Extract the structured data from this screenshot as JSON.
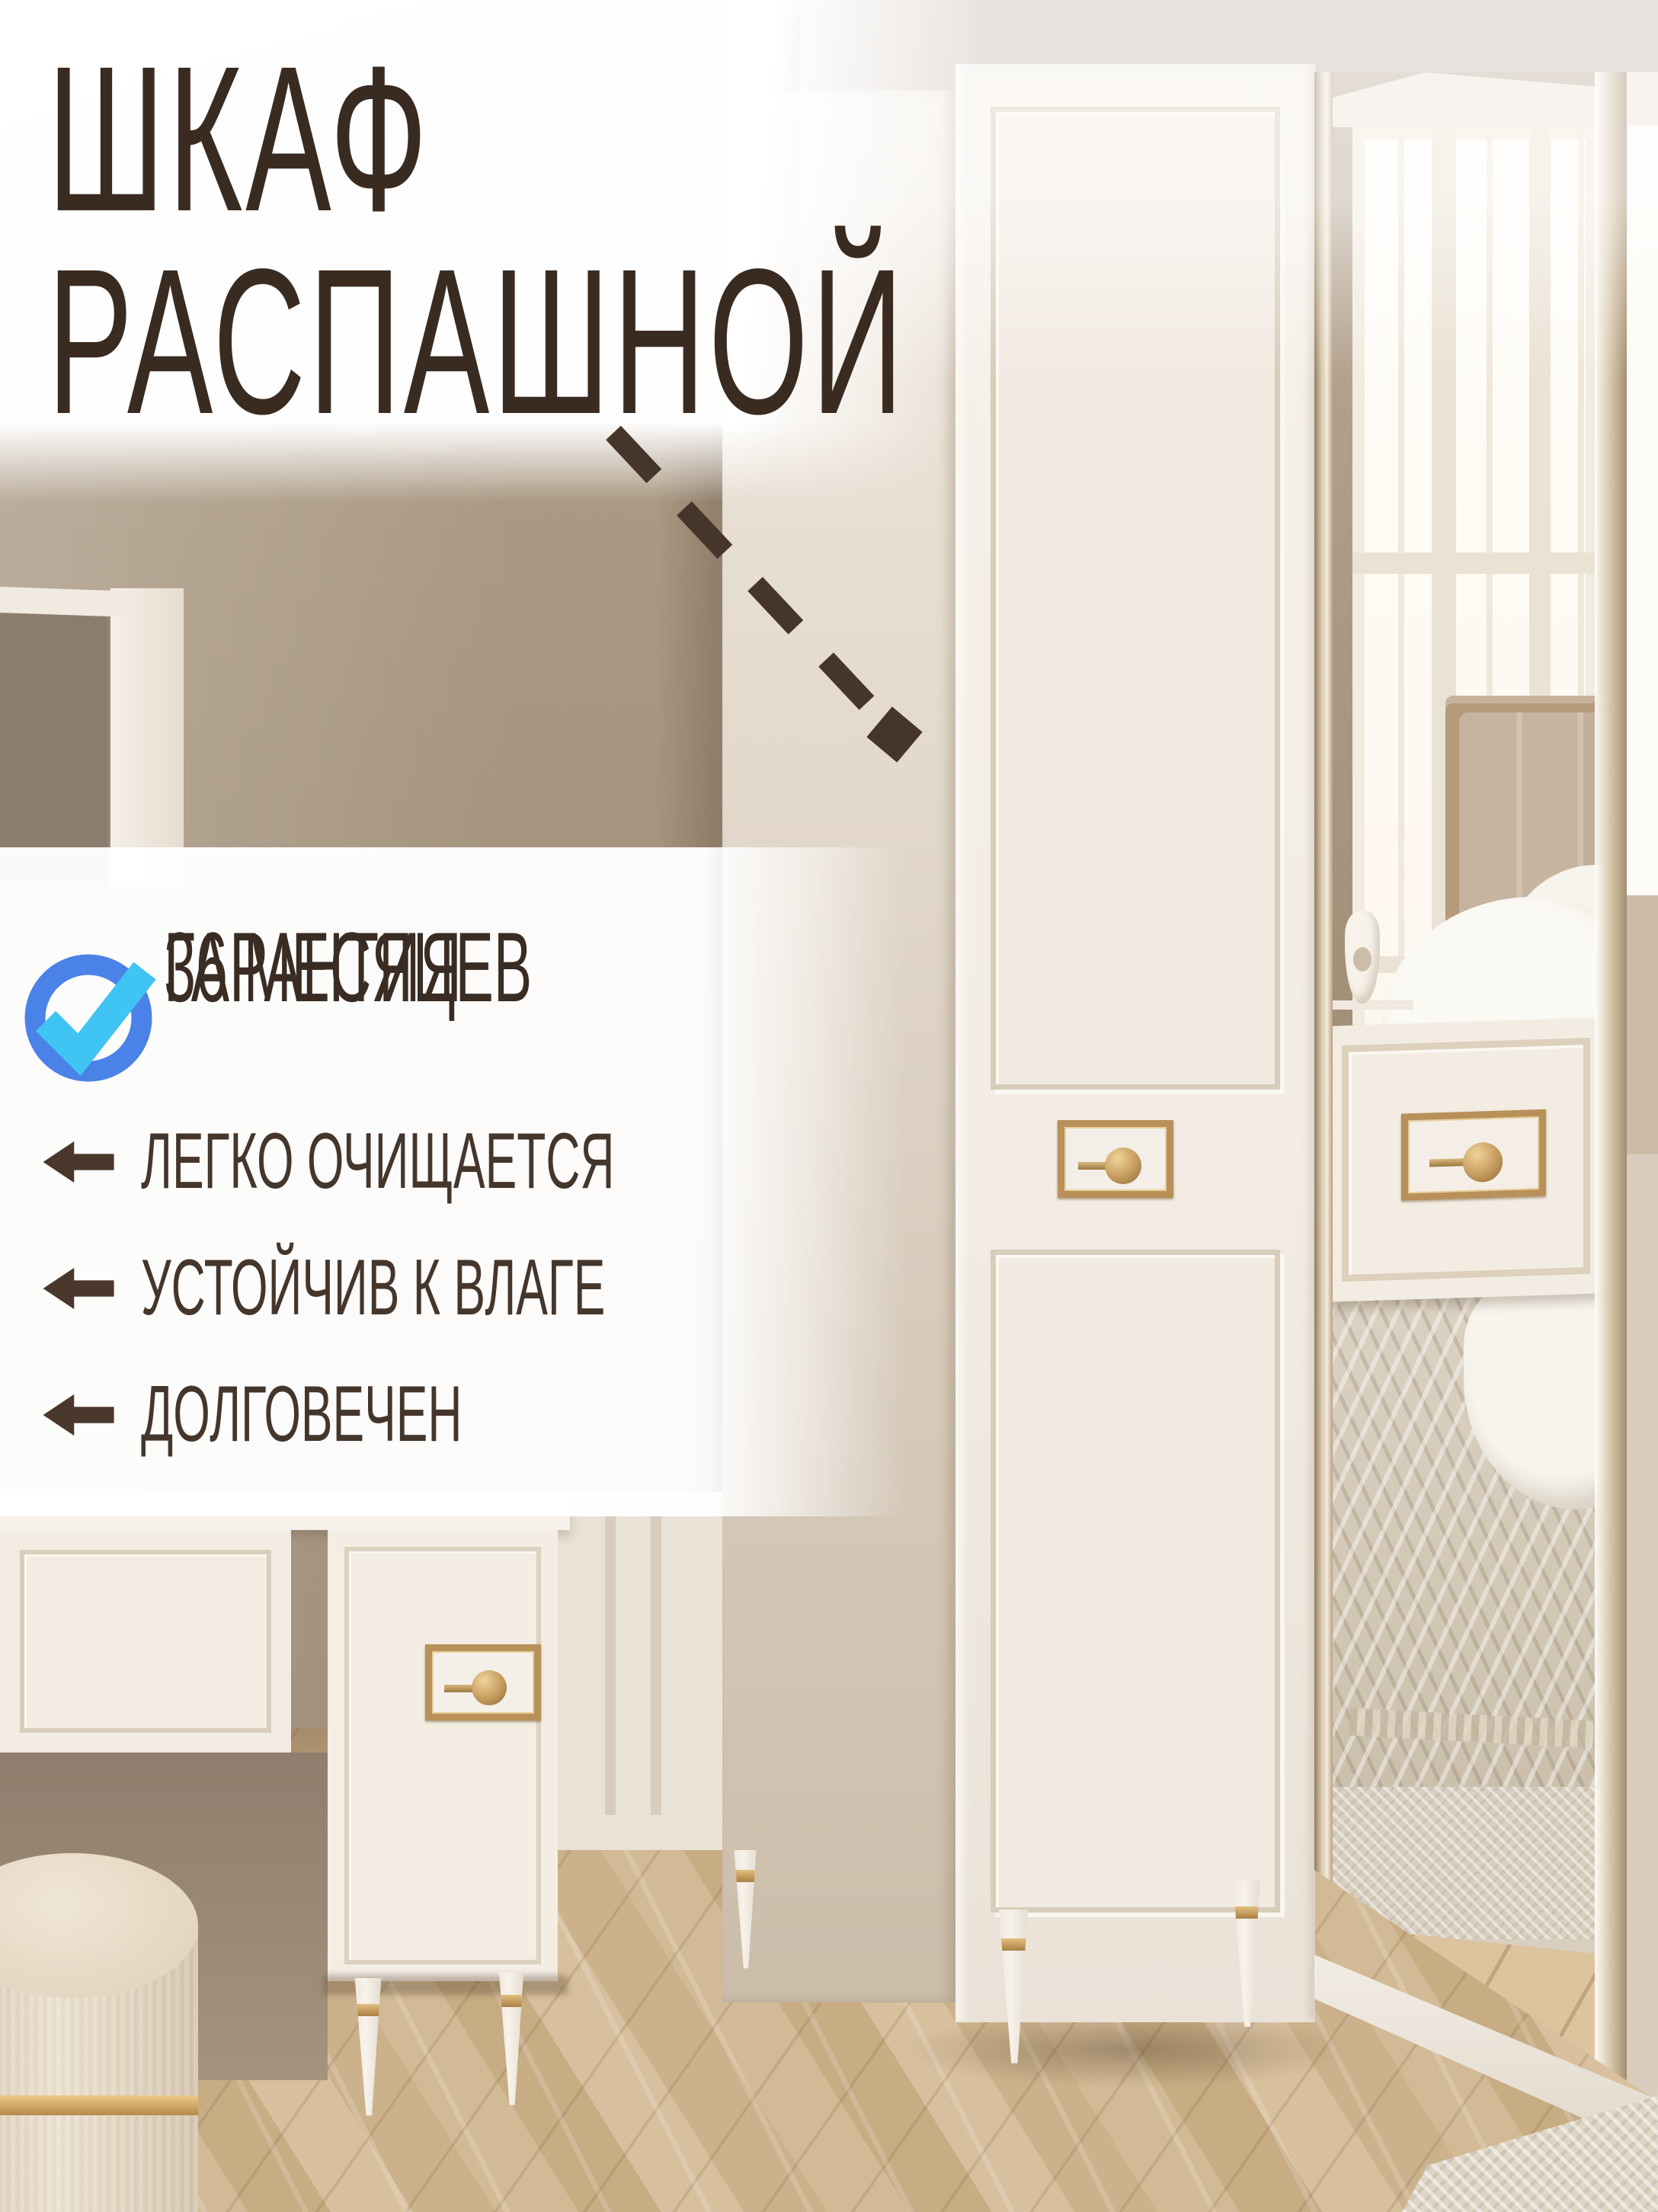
{
  "card": {
    "title": {
      "line1": "ШКАФ",
      "line2": "РАСПАШНОЙ"
    },
    "warranty": {
      "line1": "ГАРАНТИЯ",
      "line2": "36 МЕСЯЦЕВ"
    },
    "features": [
      {
        "label": "ЛЕГКО ОЧИЩАЕТСЯ"
      },
      {
        "label": "УСТОЙЧИВ К ВЛАГЕ"
      },
      {
        "label": "ДОЛГОВЕЧЕН"
      }
    ]
  },
  "icons": {
    "warranty": "check-circle-icon",
    "feature_bullet": "arrow-left-icon",
    "pointer": "dashed-arrow-icon"
  },
  "colors": {
    "title_text": "#3a2b21",
    "feature_text": "#45362c",
    "check_ring_blue": "#4a82e8",
    "check_mark_cyan": "#3fc4f4",
    "arrow_brown": "#46352a",
    "panel_white": "#ffffff",
    "gold_accent": "#b8905a",
    "wall_taupe": "#a39278",
    "floor_wood": "#d2b893"
  }
}
